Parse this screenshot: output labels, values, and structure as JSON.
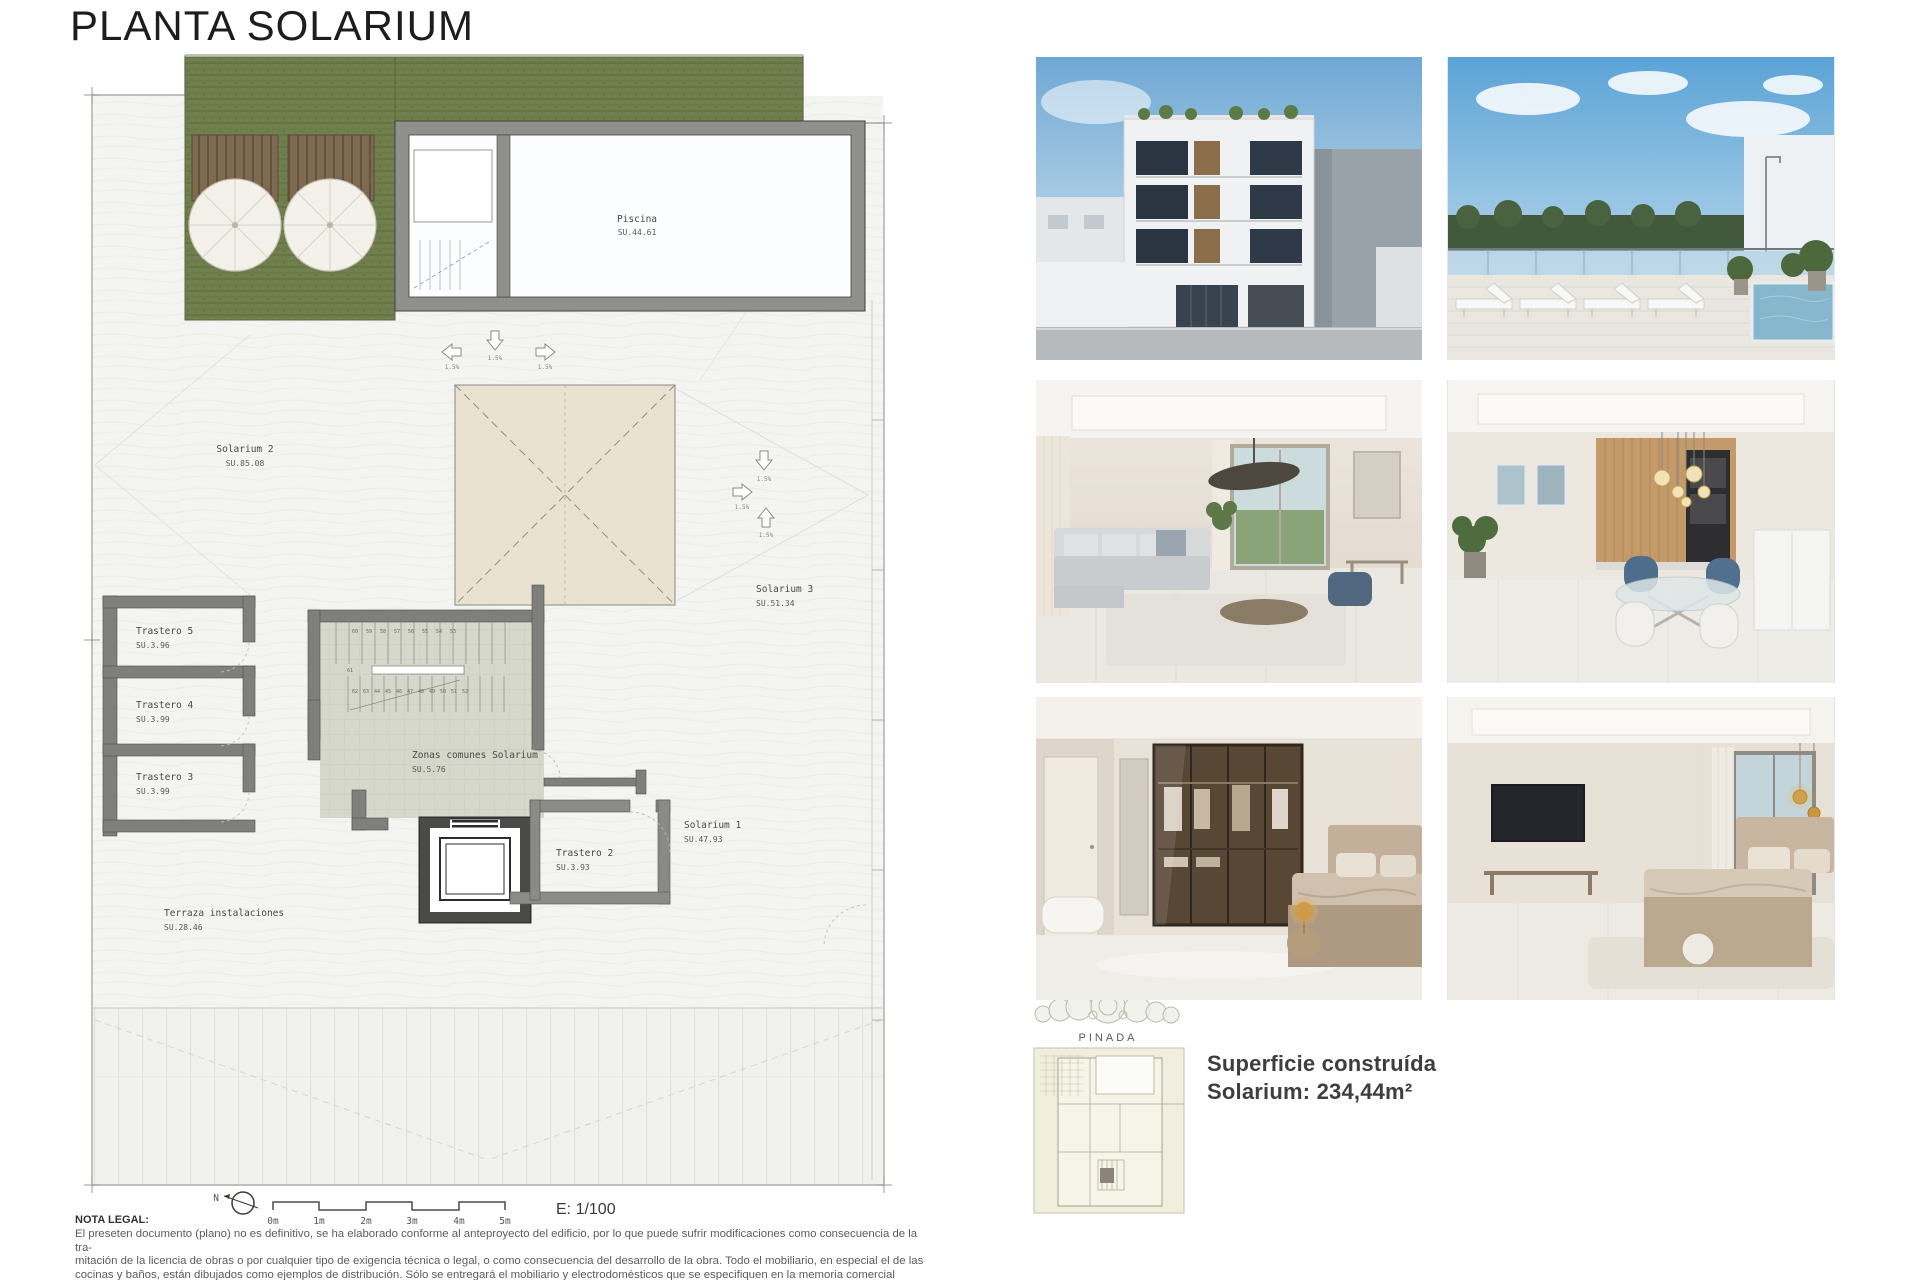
{
  "title": "PLANTA SOLARIUM",
  "plan": {
    "rooms": {
      "piscina": {
        "name": "Piscina",
        "area": "SU.44.61"
      },
      "solarium2": {
        "name": "Solarium 2",
        "area": "SU.85.08"
      },
      "solarium3": {
        "name": "Solarium 3",
        "area": "SU.51.34"
      },
      "solarium1": {
        "name": "Solarium 1",
        "area": "SU.47.93"
      },
      "trastero5": {
        "name": "Trastero 5",
        "area": "SU.3.96"
      },
      "trastero4": {
        "name": "Trastero 4",
        "area": "SU.3.99"
      },
      "trastero3": {
        "name": "Trastero 3",
        "area": "SU.3.99"
      },
      "trastero2": {
        "name": "Trastero 2",
        "area": "SU.3.93"
      },
      "zonas": {
        "name": "Zonas comunes Solarium",
        "area": "SU.5.76"
      },
      "terraza": {
        "name": "Terraza instalaciones",
        "area": "SU.28.46"
      }
    },
    "slope": "1.5%",
    "north": "N",
    "scale_ticks": [
      "0m",
      "1m",
      "2m",
      "3m",
      "4m",
      "5m"
    ],
    "scale_ratio": "E: 1/100",
    "steps_top": [
      "60",
      "59",
      "58",
      "57",
      "56",
      "55",
      "54",
      "53"
    ],
    "steps_side": [
      "61"
    ],
    "steps_bottom": [
      "62",
      "63",
      "44",
      "45",
      "46",
      "47",
      "48",
      "49",
      "50",
      "51",
      "52"
    ]
  },
  "site_plan": {
    "label": "PINADA"
  },
  "summary": {
    "line1": "Superficie construída",
    "line2": "Solarium: 234,44m²"
  },
  "legal": {
    "heading": "NOTA LEGAL:",
    "line1": "El preseten documento (plano) no es definitivo, se ha elaborado conforme al anteproyecto del edificio, por lo que puede sufrir modificaciones como consecuencia de la tra-",
    "line2": "mitación de la licencia de obras o por cualquier tipo de exigencia técnica o legal, o como consecuencia del desarrollo de la obra. Todo el mobiliario, en especial el de las",
    "line3": "cocinas y baños, están dibujados como ejemplos de distribución. Sólo se entregará el mobiliario y electrodomésticos que se especifiquen en la memoria comercial definitiva.",
    "line4": "Es un plano meramente informativo, sin contenido contractual."
  },
  "colors": {
    "grass": "#6F7F4D",
    "wall": "#7F7F7C",
    "skylight": "#E9E2D1",
    "stair_tile": "#D6D8CB",
    "accent_text": "#3E3E3E"
  }
}
